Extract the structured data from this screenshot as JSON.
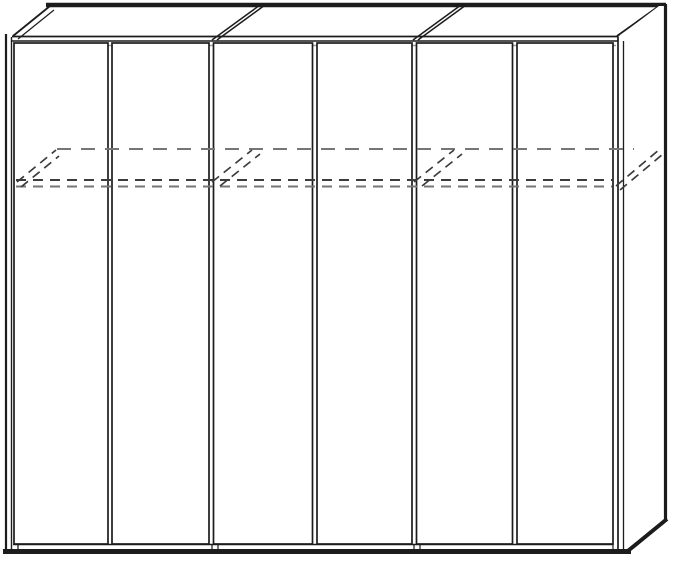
{
  "page": {
    "background": "#ffffff"
  },
  "diagram": {
    "kind": "furniture-technical-line-drawing",
    "subject": "Six-door wardrobe, front elevation with perspective top face and right side panel",
    "door_count": 6,
    "module_count": 3,
    "hidden_feature": "interior shelf indicated by dashed hidden lines across the upper third",
    "doors": [
      "door-1",
      "door-2",
      "door-3",
      "door-4",
      "door-5",
      "door-6"
    ],
    "colors": {
      "background": "#ffffff",
      "line": "#1c1c1c",
      "line_light": "#9a9a9a",
      "dash_dark": "#3c3c3c",
      "dash_light": "#767676"
    }
  }
}
